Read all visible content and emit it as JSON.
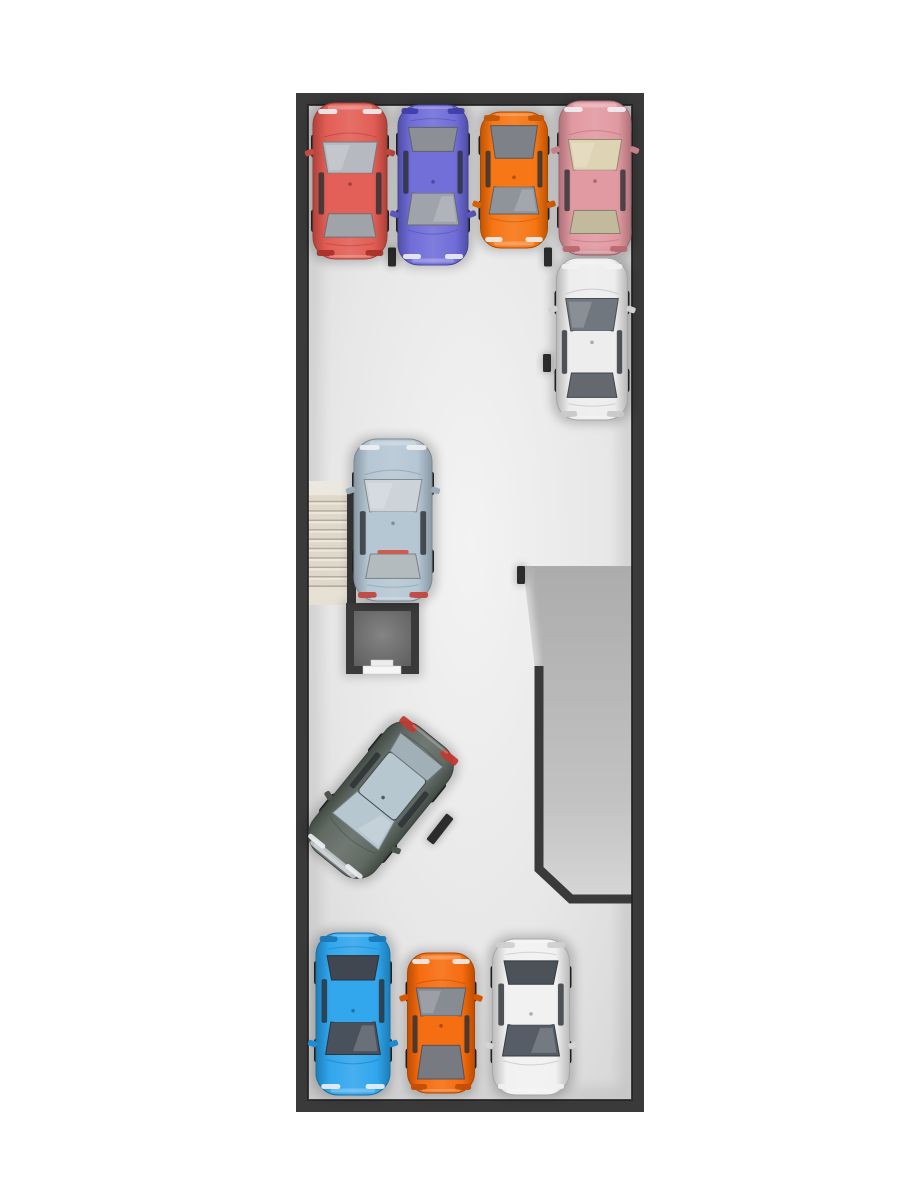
{
  "meta": {
    "description": "Top-down 3D render of a parking garage floor plan with parked cars, staircase, elevator shaft and exit ramp",
    "canvas": {
      "width": 900,
      "height": 1200
    }
  },
  "palette": {
    "background": "#ffffff",
    "wall": "#3a3a3a",
    "wall_edge": "#232323",
    "floor_center": "#f3f3f3",
    "floor_mid": "#e7e7e7",
    "floor_edge": "#d4d4d4",
    "ramp_top": "#acacac",
    "ramp_mid": "#c2c2c2",
    "ramp_bottom": "#d6d6d6",
    "stair_tread": "#e4ddcf",
    "stair_nosing": "#f3eee2",
    "stair_riser_shadow": "#b3ab9a",
    "stair_landing_top": "#f1eee7",
    "stair_landing_bottom": "#ece6da",
    "room_center": "#848484",
    "room_edge": "#575757",
    "door_sill": "#f6f6f6",
    "wheel_stop": "#2c2c2c"
  },
  "garage": {
    "outer": {
      "x": 296,
      "y": 93,
      "width": 348,
      "height": 1019
    },
    "wall_thickness": 12
  },
  "ramp": {
    "polygon": [
      [
        523,
        566
      ],
      [
        632,
        566
      ],
      [
        632,
        899
      ],
      [
        569,
        899
      ],
      [
        535,
        868
      ],
      [
        535,
        668
      ]
    ],
    "wall_path": [
      [
        539,
        666
      ],
      [
        539,
        869
      ],
      [
        571,
        899
      ],
      [
        633,
        899
      ]
    ],
    "wall_width": 9
  },
  "stairs": {
    "x": 308,
    "y": 481,
    "width": 39,
    "steps_top": 493,
    "steps_bottom": 587,
    "bottom": 605,
    "step_count": 10,
    "side_wall": {
      "x": 347,
      "y": 492,
      "width": 9,
      "height": 113
    }
  },
  "elevator": {
    "x": 346,
    "y": 603,
    "width": 73,
    "height": 71,
    "wall": 8,
    "door": {
      "x1": 363,
      "x2": 401
    },
    "sill_tab": {
      "x1": 371,
      "x2": 393
    }
  },
  "wheel_stops": [
    {
      "x": 392,
      "y": 257,
      "w": 8,
      "h": 19,
      "rot": 0
    },
    {
      "x": 548,
      "y": 257,
      "w": 8,
      "h": 19,
      "rot": 0
    },
    {
      "x": 547,
      "y": 363,
      "w": 8,
      "h": 18,
      "rot": 0
    },
    {
      "x": 521,
      "y": 575,
      "w": 8,
      "h": 18,
      "rot": 0
    },
    {
      "x": 440,
      "y": 829,
      "w": 9,
      "h": 33,
      "rot": 38
    }
  ],
  "cars": [
    {
      "id": "sedan-red",
      "color_name": "red",
      "type": "sedan",
      "cx": 350,
      "cy": 181,
      "width": 74,
      "length": 156,
      "rot": 0,
      "body": "#e0544a",
      "glass": "#b6bac0",
      "tail": "#a93228"
    },
    {
      "id": "sedan-indigo",
      "color_name": "indigo-blue",
      "type": "sedan",
      "cx": 433,
      "cy": 185,
      "width": 70,
      "length": 160,
      "rot": 180,
      "body": "#6764d6",
      "glass": "#9fa3ab",
      "tail": "#3f3da8"
    },
    {
      "id": "crossover-orange",
      "color_name": "orange",
      "type": "hatch",
      "cx": 514,
      "cy": 180,
      "width": 67,
      "length": 136,
      "rot": 180,
      "body": "#f66d04",
      "glass": "#8f949b",
      "tail": "#c2560a"
    },
    {
      "id": "sedan-pink",
      "color_name": "salmon-pink",
      "type": "sedan",
      "cx": 595,
      "cy": 178,
      "width": 72,
      "length": 154,
      "rot": 0,
      "body": "#e0929b",
      "glass": "#ded3b2",
      "tail": "#b96a72"
    },
    {
      "id": "sedan-white-top",
      "color_name": "white",
      "type": "sedan",
      "cx": 592,
      "cy": 339,
      "width": 71,
      "length": 162,
      "rot": 0,
      "body": "#ececec",
      "glass": "#70777e",
      "tail": "#c9c9c9"
    },
    {
      "id": "sedan-steelblue",
      "color_name": "steel-blue",
      "type": "sedan",
      "cx": 393,
      "cy": 520,
      "width": 78,
      "length": 162,
      "rot": 0,
      "body": "#b0c3d1",
      "glass": "#cdd4d9",
      "tail": "#c04840",
      "brake_strip": true
    },
    {
      "id": "suv-gray-green",
      "color_name": "gray-green",
      "type": "suv",
      "cx": 381,
      "cy": 800,
      "width": 80,
      "length": 162,
      "rot": 219,
      "body": "#566059",
      "glass": "#b7c7d0",
      "tail": "#c03a30"
    },
    {
      "id": "coupe-azure",
      "color_name": "azure-blue",
      "type": "sedan",
      "cx": 353,
      "cy": 1014,
      "width": 74,
      "length": 162,
      "rot": 180,
      "body": "#24a0ec",
      "glass": "#49515c",
      "tail": "#1878b8"
    },
    {
      "id": "hatch-orange",
      "color_name": "orange",
      "type": "hatch",
      "cx": 441,
      "cy": 1023,
      "width": 67,
      "length": 140,
      "rot": 0,
      "body": "#f56300",
      "glass": "#878c93",
      "tail": "#c24e06"
    },
    {
      "id": "sedan-white-bottom",
      "color_name": "white",
      "type": "sedan",
      "cx": 531,
      "cy": 1017,
      "width": 77,
      "length": 156,
      "rot": 180,
      "body": "#f0f0f0",
      "glass": "#565d66",
      "tail": "#cfcfcf"
    }
  ]
}
